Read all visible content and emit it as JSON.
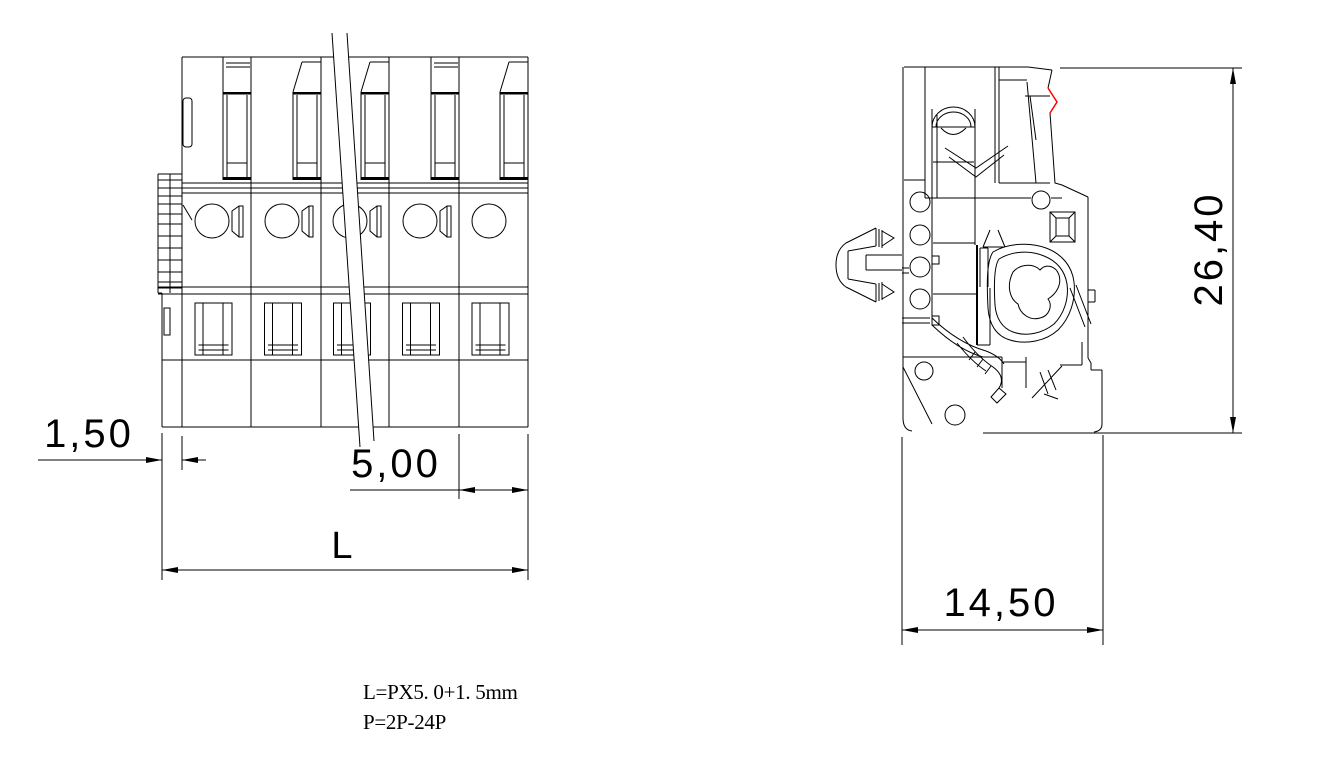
{
  "page": {
    "background": "#ffffff"
  },
  "drawing": {
    "front_view": {
      "dims": {
        "pole_offset": "1,50",
        "pitch": "5,00",
        "total_length": "L"
      }
    },
    "side_view": {
      "dims": {
        "height": "26,40",
        "depth": "14,50"
      }
    },
    "notes": {
      "formula": "L=PX5. 0+1. 5mm",
      "pole_range": "P=2P-24P"
    },
    "colors": {
      "line": "#000000",
      "highlight": "#ff0000",
      "background": "#ffffff"
    }
  }
}
